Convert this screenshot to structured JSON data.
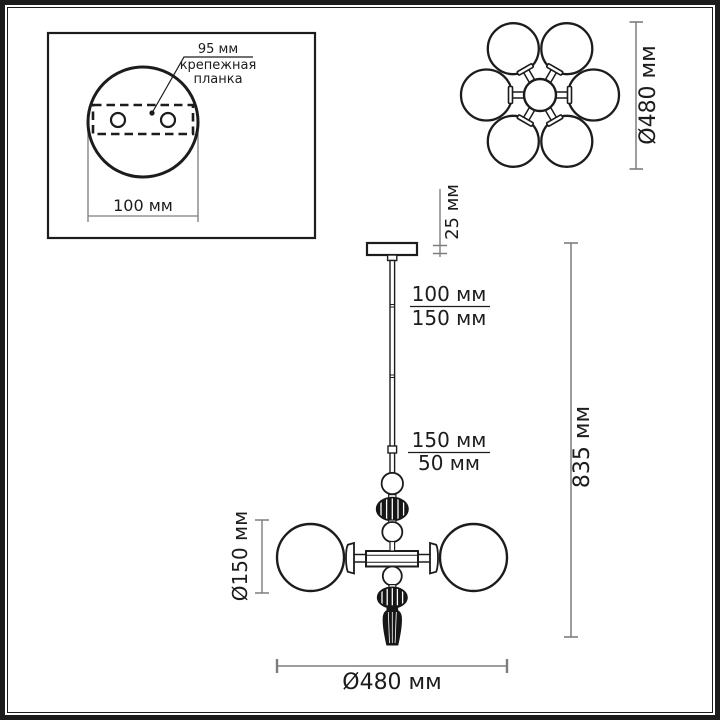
{
  "colors": {
    "outline": "#1c1c1c",
    "dimension": "#7d7d7d",
    "dark": "#161616",
    "text-color": "#1c1c1c",
    "background": "#ffffff"
  },
  "drawing": {
    "inset": {
      "hole_spacing_label": "95 мм",
      "bracket_label_line1": "крепежная",
      "bracket_label_line2": "планка",
      "base_width_label": "100 мм"
    },
    "top_view": {
      "diameter_label": "Ø480 мм"
    },
    "side_view": {
      "canopy_height_label": "25 мм",
      "rod_upper_option_a": "100 мм",
      "rod_upper_option_b": "150 мм",
      "rod_lower_option_a": "150 мм",
      "rod_lower_option_b": "50 мм",
      "overall_height_label": "835 мм",
      "globe_diameter_label": "Ø150 мм",
      "overall_width_label": "Ø480 мм"
    }
  }
}
